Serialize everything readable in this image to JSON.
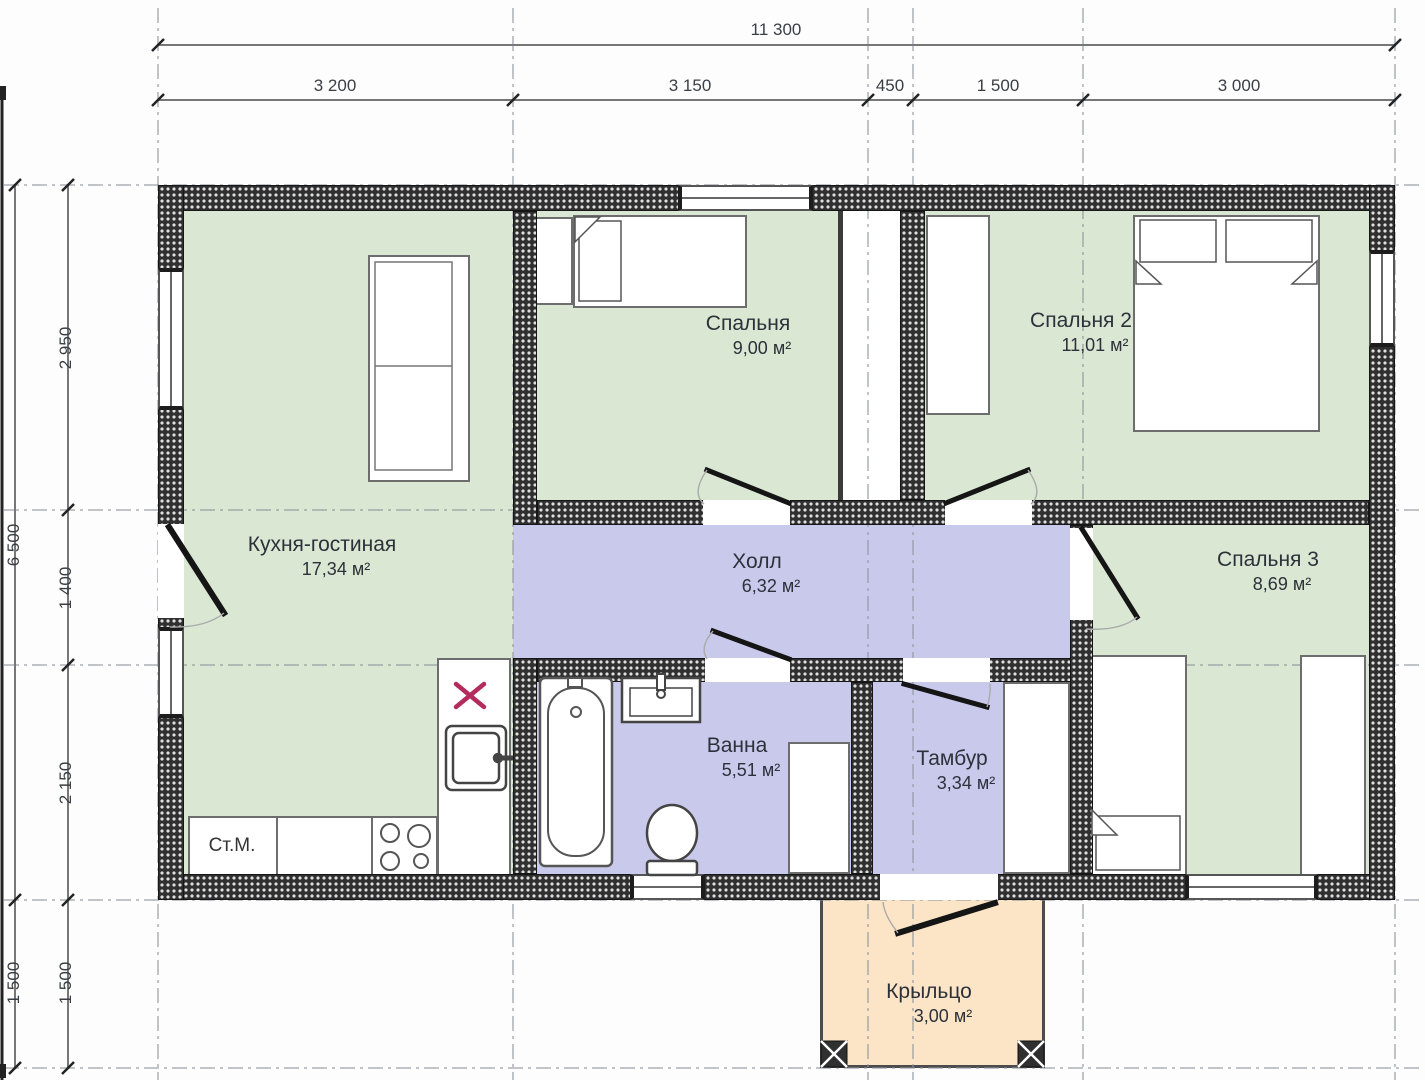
{
  "plan": {
    "dimensions": {
      "top_total": "11 300",
      "top_segments": [
        "3 200",
        "3 150",
        "450",
        "1 500",
        "3 000"
      ],
      "left_outer": [
        "6 500",
        "1 500"
      ],
      "left_inner": [
        "2 950",
        "1 400",
        "2 150",
        "1 500"
      ]
    },
    "rooms": {
      "kitchen": {
        "name": "Кухня-гостиная",
        "area": "17,34 м²"
      },
      "bedroom1": {
        "name": "Спальня",
        "area": "9,00 м²"
      },
      "bedroom2": {
        "name": "Спальня 2",
        "area": "11,01 м²"
      },
      "bedroom3": {
        "name": "Спальня 3",
        "area": "8,69 м²"
      },
      "hall": {
        "name": "Холл",
        "area": "6,32 м²"
      },
      "bath": {
        "name": "Ванна",
        "area": "5,51 м²"
      },
      "tambur": {
        "name": "Тамбур",
        "area": "3,34 м²"
      },
      "porch": {
        "name": "Крыльцо",
        "area": "3,00 м²"
      }
    },
    "labels": {
      "washing_machine": "Ст.М."
    },
    "colors": {
      "room_green": "#d9e7d3",
      "room_lavender": "#c9c9ec",
      "porch": "#fbe5c6",
      "wall_dark": "#303030",
      "marker_red": "#b42b5e"
    }
  }
}
